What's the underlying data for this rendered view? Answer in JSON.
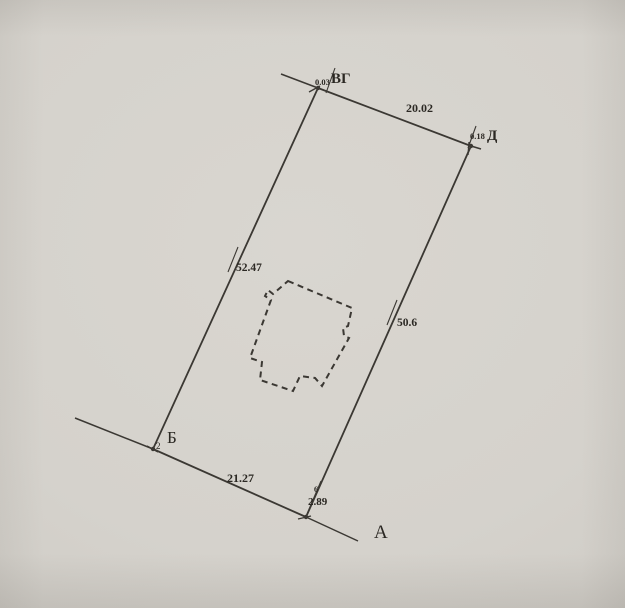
{
  "colors": {
    "background": "#d5d2cc",
    "line": "#3b3833",
    "text": "#2b2823"
  },
  "diagram": {
    "canvas": {
      "width": 625,
      "height": 608
    },
    "parcel": {
      "points": [
        [
          318,
          88
        ],
        [
          471,
          146
        ],
        [
          306,
          517
        ],
        [
          153,
          449
        ]
      ]
    },
    "extensions": [
      [
        281,
        74,
        318,
        88
      ],
      [
        471,
        146,
        481,
        149
      ],
      [
        75,
        418,
        153,
        449
      ],
      [
        306,
        517,
        358,
        541
      ]
    ],
    "slashes": [
      [
        326,
        93,
        335,
        68
      ],
      [
        468,
        148,
        476,
        126
      ],
      [
        228,
        272,
        238,
        247
      ],
      [
        387,
        325,
        397,
        300
      ],
      [
        307,
        514,
        321,
        481
      ]
    ],
    "ticks": [
      [
        469,
        142,
        468,
        155
      ],
      [
        298,
        519,
        311,
        516
      ],
      [
        147,
        446,
        158,
        452
      ],
      [
        309,
        92,
        320,
        86
      ]
    ],
    "dots": [
      [
        318,
        88
      ],
      [
        471,
        146
      ],
      [
        153,
        449
      ],
      [
        306,
        517
      ]
    ],
    "building": {
      "points": [
        [
          288,
          281
        ],
        [
          352,
          308
        ],
        [
          348,
          326
        ],
        [
          343,
          328
        ],
        [
          344,
          336
        ],
        [
          349,
          338
        ],
        [
          322,
          386
        ],
        [
          315,
          378
        ],
        [
          300,
          376
        ],
        [
          293,
          391
        ],
        [
          260,
          380
        ],
        [
          262,
          362
        ],
        [
          250,
          358
        ],
        [
          271,
          300
        ],
        [
          265,
          296
        ],
        [
          268,
          290
        ],
        [
          273,
          294
        ]
      ],
      "closed": true
    },
    "labels": [
      {
        "name": "corner-offset-top",
        "text": "0.03",
        "x": 315,
        "y": 85,
        "size": 8.5,
        "bold": true
      },
      {
        "name": "corner-label-vg",
        "text": "ВГ",
        "x": 331,
        "y": 83,
        "size": 15,
        "bold": true
      },
      {
        "name": "dim-top-edge",
        "text": "20.02",
        "x": 406,
        "y": 112,
        "size": 12,
        "bold": true
      },
      {
        "name": "corner-offset-d",
        "text": "0.18",
        "x": 470,
        "y": 139,
        "size": 8.5,
        "bold": true
      },
      {
        "name": "corner-label-d",
        "text": "Д",
        "x": 487,
        "y": 140,
        "size": 15,
        "bold": true
      },
      {
        "name": "dim-left-edge",
        "text": "52.47",
        "x": 236,
        "y": 271,
        "size": 11.5,
        "bold": true
      },
      {
        "name": "dim-right-edge",
        "text": "50.6",
        "x": 397,
        "y": 326,
        "size": 11.5,
        "bold": true
      },
      {
        "name": "corner-label-b",
        "text": "Б",
        "x": 167,
        "y": 443,
        "size": 17,
        "bold": false
      },
      {
        "name": "corner-point-2",
        "text": "2",
        "x": 156,
        "y": 449,
        "size": 9,
        "bold": false
      },
      {
        "name": "dim-bottom-edge",
        "text": "21.27",
        "x": 227,
        "y": 482,
        "size": 12,
        "bold": true
      },
      {
        "name": "corner-point-6",
        "text": "6",
        "x": 314,
        "y": 492,
        "size": 8,
        "bold": true
      },
      {
        "name": "dim-offset-bottom",
        "text": "2.89",
        "x": 308,
        "y": 505,
        "size": 11,
        "bold": true
      },
      {
        "name": "corner-label-a",
        "text": "А",
        "x": 374,
        "y": 538,
        "size": 19,
        "bold": false
      }
    ]
  }
}
